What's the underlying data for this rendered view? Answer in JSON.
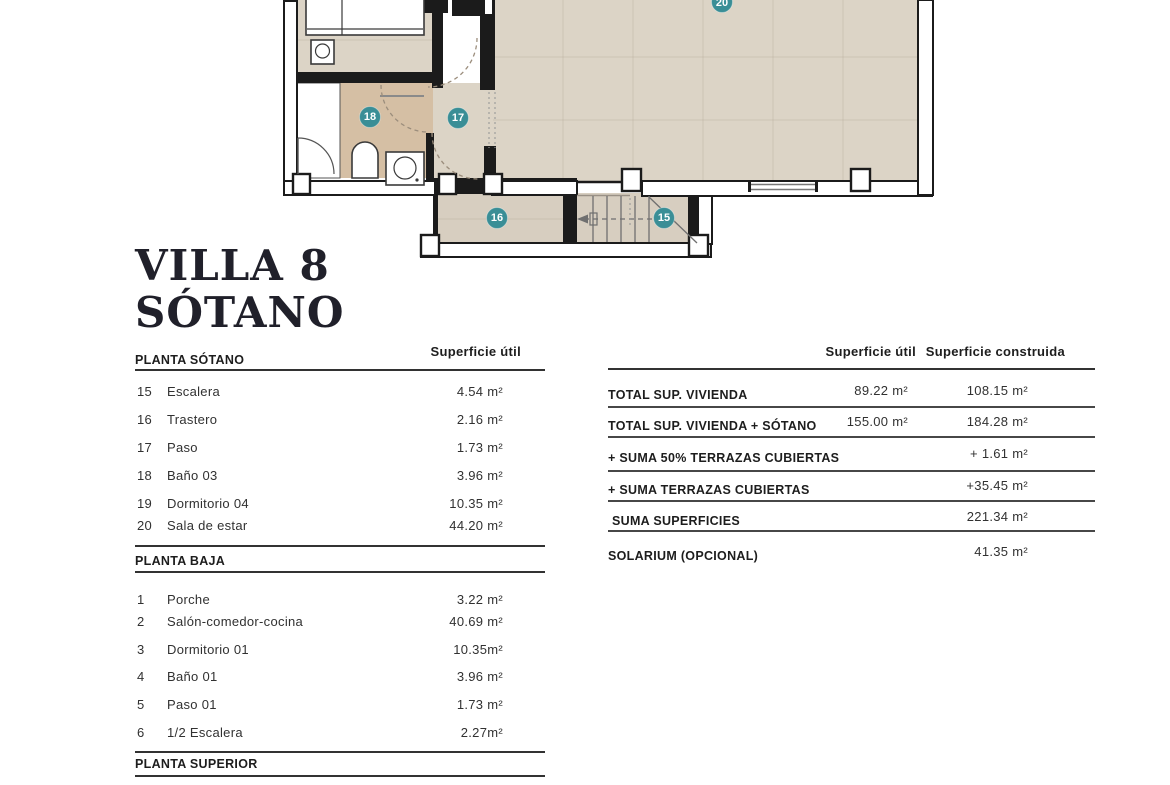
{
  "title": {
    "line1": "VILLA 8",
    "line2": "SÓTANO"
  },
  "floorplan": {
    "colors": {
      "floor": "#dcd4c6",
      "floor_bath": "#d5bfa4",
      "floor_storage": "#d7cec0",
      "wall": "#1b1b1b",
      "marker": "#3a8e96"
    },
    "markers": [
      {
        "id": "15"
      },
      {
        "id": "16"
      },
      {
        "id": "17"
      },
      {
        "id": "18"
      },
      {
        "id": "20"
      }
    ]
  },
  "left_table": {
    "sections": [
      {
        "header": "PLANTA SÓTANO",
        "col_header": "Superficie útil",
        "rows": [
          {
            "num": "15",
            "name": "Escalera",
            "value": "4.54 m²"
          },
          {
            "num": "16",
            "name": "Trastero",
            "value": "2.16 m²"
          },
          {
            "num": "17",
            "name": "Paso",
            "value": "1.73 m²"
          },
          {
            "num": "18",
            "name": "Baño 03",
            "value": "3.96 m²"
          },
          {
            "num": "19",
            "name": "Dormitorio 04",
            "value": "10.35 m²"
          },
          {
            "num": "20",
            "name": "Sala de estar",
            "value": "44.20 m²"
          }
        ]
      },
      {
        "header": "PLANTA BAJA",
        "rows": [
          {
            "num": "1",
            "name": "Porche",
            "value": "3.22 m²"
          },
          {
            "num": "2",
            "name": "Salón-comedor-cocina",
            "value": "40.69 m²"
          },
          {
            "num": "3",
            "name": "Dormitorio 01",
            "value": "10.35m²"
          },
          {
            "num": "4",
            "name": "Baño 01",
            "value": "3.96 m²"
          },
          {
            "num": "5",
            "name": "Paso 01",
            "value": "1.73 m²"
          },
          {
            "num": "6",
            "name": "1/2 Escalera",
            "value": "2.27m²"
          }
        ]
      },
      {
        "header": "PLANTA SUPERIOR",
        "rows": []
      }
    ]
  },
  "right_table": {
    "col_headers": {
      "util": "Superficie útil",
      "construida": "Superficie construida"
    },
    "rows": [
      {
        "label": "TOTAL SUP. VIVIENDA",
        "util": "89.22 m²",
        "construida": "108.15 m²"
      },
      {
        "label": "TOTAL SUP. VIVIENDA + SÓTANO",
        "util": "155.00 m²",
        "construida": "184.28 m²"
      },
      {
        "label": "+ SUMA 50% TERRAZAS CUBIERTAS",
        "util": "",
        "construida": "+ 1.61 m²"
      },
      {
        "label": "+ SUMA TERRAZAS CUBIERTAS",
        "util": "",
        "construida": "+35.45 m²"
      },
      {
        "label": "SUMA SUPERFICIES",
        "util": "",
        "construida": "221.34 m²"
      },
      {
        "label": "SOLARIUM (OPCIONAL)",
        "util": "",
        "construida": "41.35 m²"
      }
    ]
  }
}
